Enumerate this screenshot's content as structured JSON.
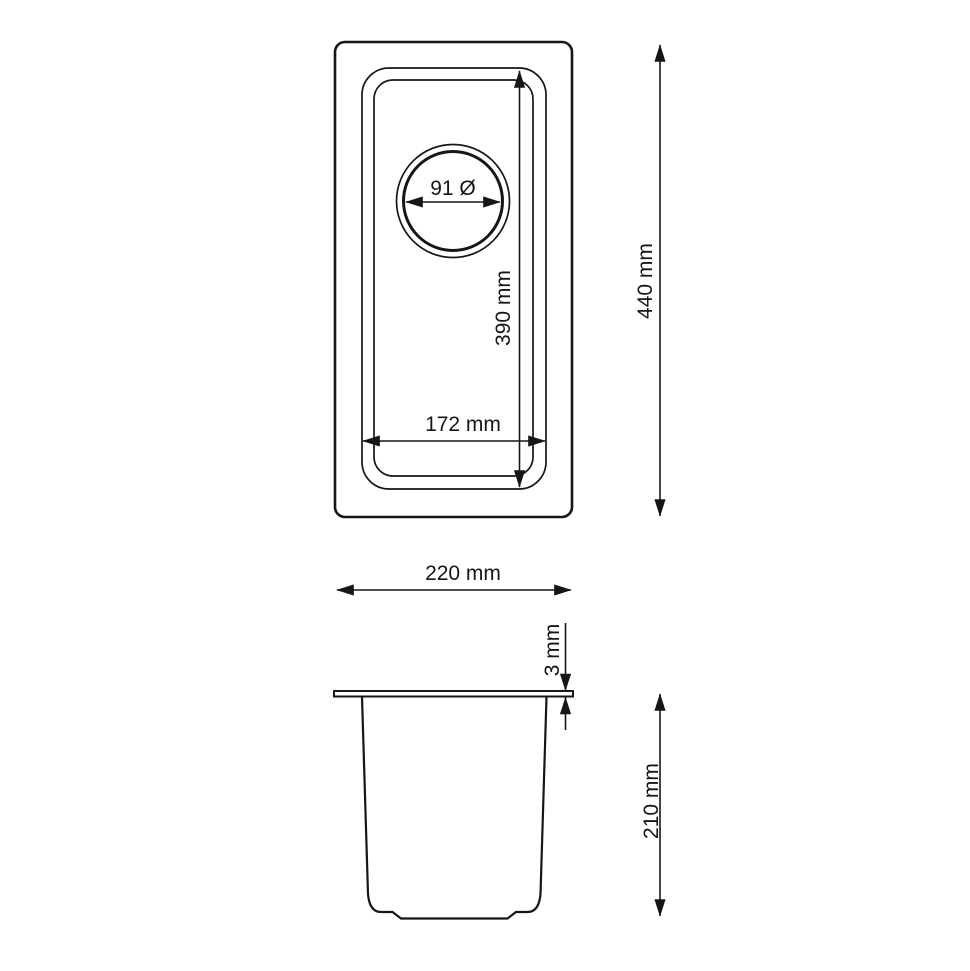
{
  "colors": {
    "ink": "#161616",
    "background": "#ffffff"
  },
  "unit": "mm",
  "top_view": {
    "overall_width": {
      "label": "220 mm",
      "value": 220,
      "unit": "mm"
    },
    "overall_length": {
      "label": "440 mm",
      "value": 440,
      "unit": "mm"
    },
    "bowl_width": {
      "label": "172 mm",
      "value": 172,
      "unit": "mm"
    },
    "bowl_length": {
      "label": "390 mm",
      "value": 390,
      "unit": "mm"
    },
    "drain_diameter": {
      "label": "91 Ø",
      "value": 91,
      "unit": "mm"
    }
  },
  "side_view": {
    "rim_thickness": {
      "label": "3 mm",
      "value": 3,
      "unit": "mm"
    },
    "bowl_depth": {
      "label": "210 mm",
      "value": 210,
      "unit": "mm"
    }
  }
}
